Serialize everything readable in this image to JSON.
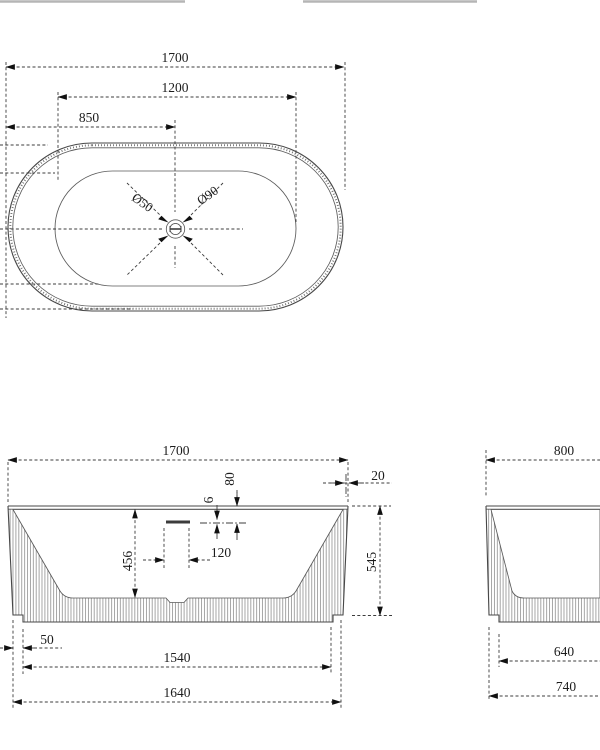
{
  "drawing_type": "bathtub-technical-drawing",
  "colors": {
    "line": "#474747",
    "dimension": "#1c1c1c",
    "hatch": "#8f8f8f",
    "crop_edge": "#b5b5b5",
    "background": "#ffffff"
  },
  "views": {
    "top": {
      "length_overall": "1700",
      "length_inner": "1200",
      "length_half": "850",
      "drain_diameter": "Ø50",
      "overflow_diameter": "Ø90"
    },
    "front": {
      "length_overall": "1700",
      "rim_thickness": "20",
      "overflow_drop": "80",
      "overflow_slot_height": "6",
      "overflow_width": "120",
      "inner_depth": "456",
      "height_overall": "545",
      "base_offset": "50",
      "base_inner_length": "1540",
      "base_outer_length": "1640"
    },
    "side": {
      "width_overall": "800",
      "base_inner_width": "640",
      "base_outer_width": "740"
    }
  }
}
